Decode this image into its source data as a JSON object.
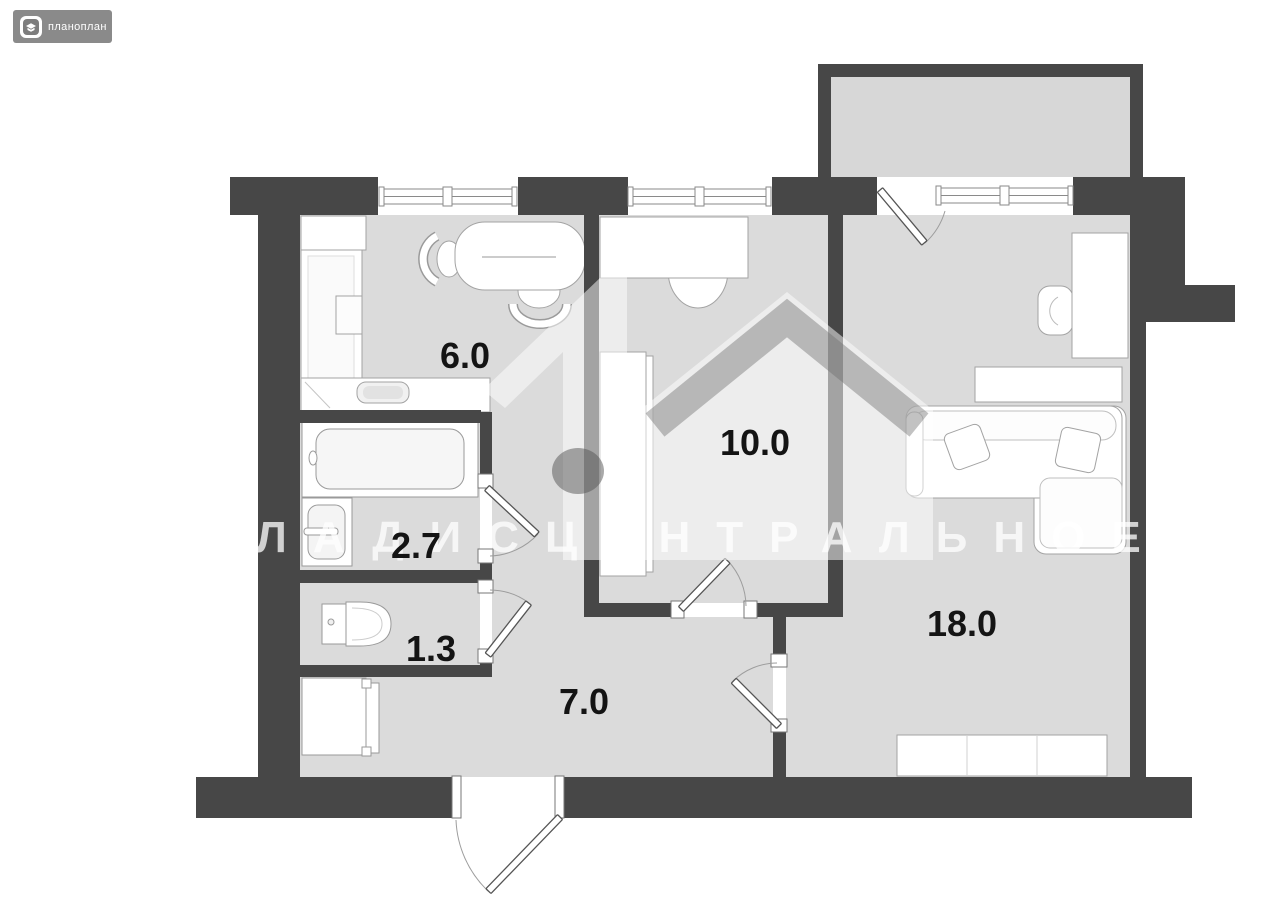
{
  "logo": {
    "text": "планоплан",
    "icon": "planoplan-cube-icon",
    "bg_color": "#8a8a8a"
  },
  "watermark": {
    "text": "ВЛАДИСЦЕНТРАЛЬНОЕ",
    "logo": "one-house-watermark"
  },
  "palette": {
    "wall": "#474747",
    "floor": "#dbdbdb",
    "fixture": "#ffffff",
    "fixture_outline": "#a3a3a3",
    "label": "#141414",
    "watermark_white": "rgba(255,255,255,0.72)"
  },
  "rooms": [
    {
      "id": "kitchen",
      "area": "6.0"
    },
    {
      "id": "bathroom",
      "area": "2.7"
    },
    {
      "id": "toilet",
      "area": "1.3"
    },
    {
      "id": "hallway",
      "area": "7.0"
    },
    {
      "id": "bedroom",
      "area": "10.0"
    },
    {
      "id": "living-room",
      "area": "18.0"
    }
  ]
}
